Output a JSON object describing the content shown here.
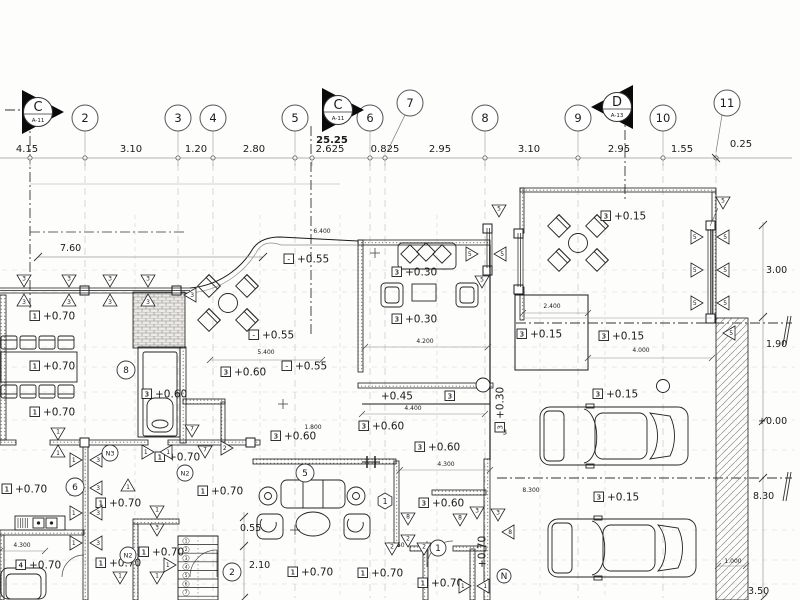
{
  "drawing": {
    "type": "architectural-floor-plan",
    "overall_dim": "25.25",
    "section_markers": [
      {
        "label": "C",
        "ref": "A-11",
        "x": 38,
        "y": 112,
        "dir": "r"
      },
      {
        "label": "C",
        "ref": "A-11",
        "x": 338,
        "y": 110,
        "dir": "r"
      },
      {
        "label": "D",
        "ref": "A-13",
        "x": 617,
        "y": 107,
        "dir": "l"
      }
    ],
    "grid_bubbles": [
      {
        "label": "2",
        "x": 85,
        "y": 118
      },
      {
        "label": "3",
        "x": 178,
        "y": 118
      },
      {
        "label": "4",
        "x": 213,
        "y": 118
      },
      {
        "label": "5",
        "x": 295,
        "y": 118
      },
      {
        "label": "6",
        "x": 370,
        "y": 118
      },
      {
        "label": "7",
        "x": 410,
        "y": 103,
        "lx": 387,
        "ly": 152
      },
      {
        "label": "8",
        "x": 485,
        "y": 118
      },
      {
        "label": "9",
        "x": 578,
        "y": 118
      },
      {
        "label": "10",
        "x": 663,
        "y": 118
      },
      {
        "label": "11",
        "x": 727,
        "y": 103,
        "lx": 716,
        "ly": 152
      }
    ],
    "top_dims": [
      {
        "t": "4.15",
        "x": 27,
        "y": 152
      },
      {
        "t": "3.10",
        "x": 131,
        "y": 152
      },
      {
        "t": "1.20",
        "x": 196,
        "y": 152
      },
      {
        "t": "2.80",
        "x": 254,
        "y": 152
      },
      {
        "t": "2.625",
        "x": 330,
        "y": 152
      },
      {
        "t": "0.825",
        "x": 385,
        "y": 152
      },
      {
        "t": "2.95",
        "x": 440,
        "y": 152
      },
      {
        "t": "3.10",
        "x": 529,
        "y": 152
      },
      {
        "t": "2.95",
        "x": 619,
        "y": 152
      },
      {
        "t": "1.55",
        "x": 682,
        "y": 152
      },
      {
        "t": "0.25",
        "x": 741,
        "y": 147
      }
    ],
    "dim_ticks_x": [
      30,
      85,
      178,
      213,
      295,
      312,
      370,
      385,
      485,
      578,
      663,
      716
    ],
    "overall_dim_pos": {
      "x": 332,
      "y": 143
    },
    "side_dims": [
      {
        "t": "7.60",
        "x": 60,
        "y": 251
      },
      {
        "t": "3.00",
        "x": 766,
        "y": 273
      },
      {
        "t": "1.90",
        "x": 766,
        "y": 347
      },
      {
        "t": "+0.00",
        "x": 758,
        "y": 424
      },
      {
        "t": "8.30",
        "x": 753,
        "y": 499
      },
      {
        "t": "3.50",
        "x": 748,
        "y": 594
      },
      {
        "t": "0.55",
        "x": 240,
        "y": 531
      },
      {
        "t": "2.10",
        "x": 249,
        "y": 568
      }
    ],
    "interior_dims": [
      {
        "t": "6.400",
        "x": 322,
        "y": 233
      },
      {
        "t": "5.400",
        "x": 266,
        "y": 354
      },
      {
        "t": "4.200",
        "x": 425,
        "y": 343
      },
      {
        "t": "4.400",
        "x": 413,
        "y": 410
      },
      {
        "t": "4.300",
        "x": 446,
        "y": 466
      },
      {
        "t": "1.800",
        "x": 313,
        "y": 429
      },
      {
        "t": "2.400",
        "x": 552,
        "y": 308
      },
      {
        "t": "4.000",
        "x": 641,
        "y": 352
      },
      {
        "t": "5.450",
        "x": 396,
        "y": 547
      },
      {
        "t": "4.300",
        "x": 22,
        "y": 547
      },
      {
        "t": "8.300",
        "x": 531,
        "y": 492
      },
      {
        "t": "1.000",
        "x": 733,
        "y": 563
      }
    ],
    "elevation_labels": [
      {
        "b": "1",
        "v": "+0.70",
        "x": 30,
        "y": 316
      },
      {
        "b": "1",
        "v": "+0.70",
        "x": 30,
        "y": 366
      },
      {
        "b": "1",
        "v": "+0.70",
        "x": 30,
        "y": 412
      },
      {
        "b": "1",
        "v": "+0.70",
        "x": 2,
        "y": 489
      },
      {
        "b": "4",
        "v": "+0.70",
        "x": 16,
        "y": 565
      },
      {
        "b": "1",
        "v": "+0.70",
        "x": 96,
        "y": 503
      },
      {
        "b": "1",
        "v": "+0.70",
        "x": 96,
        "y": 563
      },
      {
        "b": "1",
        "v": "+0.70",
        "x": 198,
        "y": 491
      },
      {
        "b": "1",
        "v": "+0.70",
        "x": 139,
        "y": 552
      },
      {
        "b": "1",
        "v": "+0.70",
        "x": 155,
        "y": 457
      },
      {
        "b": "1",
        "v": "+0.70",
        "x": 288,
        "y": 572
      },
      {
        "b": "1",
        "v": "+0.70",
        "x": 358,
        "y": 573
      },
      {
        "b": "1",
        "v": "+0.70",
        "x": 418,
        "y": 583
      },
      {
        "b": "-",
        "v": "+0.55",
        "x": 284,
        "y": 259
      },
      {
        "b": "-",
        "v": "+0.55",
        "x": 249,
        "y": 335
      },
      {
        "b": "-",
        "v": "+0.55",
        "x": 282,
        "y": 366
      },
      {
        "b": "3",
        "v": "+0.60",
        "x": 142,
        "y": 394
      },
      {
        "b": "3",
        "v": "+0.60",
        "x": 221,
        "y": 372
      },
      {
        "b": "3",
        "v": "+0.60",
        "x": 271,
        "y": 436
      },
      {
        "b": "3",
        "v": "+0.60",
        "x": 359,
        "y": 426
      },
      {
        "b": "3",
        "v": "+0.60",
        "x": 415,
        "y": 447
      },
      {
        "b": "3",
        "v": "+0.60",
        "x": 419,
        "y": 503
      },
      {
        "b": "3",
        "v": "+0.30",
        "x": 392,
        "y": 272
      },
      {
        "b": "3",
        "v": "+0.30",
        "x": 392,
        "y": 319
      },
      {
        "b": "3",
        "v": "+0.45",
        "x": 413,
        "y": 396,
        "rev": 1
      },
      {
        "b": "3",
        "v": "+0.30",
        "x": 500,
        "y": 432,
        "rot": -90
      },
      {
        "b": "3",
        "v": "+0.15",
        "x": 601,
        "y": 216
      },
      {
        "b": "3",
        "v": "+0.15",
        "x": 517,
        "y": 334
      },
      {
        "b": "3",
        "v": "+0.15",
        "x": 599,
        "y": 336
      },
      {
        "b": "3",
        "v": "+0.15",
        "x": 593,
        "y": 394
      },
      {
        "b": "3",
        "v": "+0.15",
        "x": 594,
        "y": 497
      },
      {
        "b": "",
        "v": "+0.70",
        "x": 482,
        "y": 568,
        "rot": -90
      }
    ],
    "triangle_markers": [
      {
        "n": "3",
        "x": 24,
        "y": 281,
        "d": "d"
      },
      {
        "n": "3",
        "x": 24,
        "y": 300,
        "d": "u"
      },
      {
        "n": "3",
        "x": 69,
        "y": 281,
        "d": "d"
      },
      {
        "n": "3",
        "x": 69,
        "y": 300,
        "d": "u"
      },
      {
        "n": "3",
        "x": 110,
        "y": 281,
        "d": "d"
      },
      {
        "n": "3",
        "x": 110,
        "y": 300,
        "d": "u"
      },
      {
        "n": "3",
        "x": 148,
        "y": 281,
        "d": "d"
      },
      {
        "n": "3",
        "x": 148,
        "y": 300,
        "d": "u"
      },
      {
        "n": "3",
        "x": 190,
        "y": 295,
        "d": "l"
      },
      {
        "n": "5",
        "x": 472,
        "y": 254,
        "d": "r"
      },
      {
        "n": "5",
        "x": 500,
        "y": 254,
        "d": "l"
      },
      {
        "n": "5",
        "x": 482,
        "y": 282,
        "d": "d"
      },
      {
        "n": "5",
        "x": 499,
        "y": 211,
        "d": "d"
      },
      {
        "n": "5",
        "x": 697,
        "y": 237,
        "d": "r"
      },
      {
        "n": "5",
        "x": 723,
        "y": 237,
        "d": "l"
      },
      {
        "n": "5",
        "x": 697,
        "y": 270,
        "d": "r"
      },
      {
        "n": "5",
        "x": 723,
        "y": 270,
        "d": "l"
      },
      {
        "n": "5",
        "x": 697,
        "y": 303,
        "d": "r"
      },
      {
        "n": "5",
        "x": 723,
        "y": 303,
        "d": "l"
      },
      {
        "n": "5",
        "x": 723,
        "y": 203,
        "d": "d"
      },
      {
        "n": "5",
        "x": 729,
        "y": 333,
        "d": "l"
      },
      {
        "n": "1",
        "x": 76,
        "y": 460,
        "d": "r"
      },
      {
        "n": "3",
        "x": 96,
        "y": 460,
        "d": "l"
      },
      {
        "n": "1",
        "x": 76,
        "y": 488,
        "d": "r"
      },
      {
        "n": "3",
        "x": 96,
        "y": 488,
        "d": "l"
      },
      {
        "n": "1",
        "x": 76,
        "y": 513,
        "d": "r"
      },
      {
        "n": "3",
        "x": 96,
        "y": 513,
        "d": "l"
      },
      {
        "n": "1",
        "x": 76,
        "y": 543,
        "d": "r"
      },
      {
        "n": "3",
        "x": 96,
        "y": 543,
        "d": "l"
      },
      {
        "n": "1",
        "x": 58,
        "y": 434,
        "d": "d"
      },
      {
        "n": "1",
        "x": 58,
        "y": 451,
        "d": "u"
      },
      {
        "n": "7",
        "x": 192,
        "y": 431,
        "d": "d"
      },
      {
        "n": "7",
        "x": 205,
        "y": 452,
        "d": "d"
      },
      {
        "n": "2",
        "x": 227,
        "y": 448,
        "d": "r"
      },
      {
        "n": "1",
        "x": 148,
        "y": 452,
        "d": "r"
      },
      {
        "n": "1",
        "x": 166,
        "y": 452,
        "d": "l"
      },
      {
        "n": "1",
        "x": 128,
        "y": 485,
        "d": "u"
      },
      {
        "n": "1",
        "x": 157,
        "y": 512,
        "d": "d"
      },
      {
        "n": "3",
        "x": 157,
        "y": 530,
        "d": "d"
      },
      {
        "n": "1",
        "x": 170,
        "y": 565,
        "d": "r"
      },
      {
        "n": "1",
        "x": 157,
        "y": 578,
        "d": "d"
      },
      {
        "n": "1",
        "x": 120,
        "y": 578,
        "d": "d"
      },
      {
        "n": "8",
        "x": 408,
        "y": 519,
        "d": "d"
      },
      {
        "n": "2",
        "x": 408,
        "y": 541,
        "d": "d"
      },
      {
        "n": "8",
        "x": 460,
        "y": 520,
        "d": "d"
      },
      {
        "n": "3",
        "x": 477,
        "y": 513,
        "d": "d"
      },
      {
        "n": "3",
        "x": 498,
        "y": 515,
        "d": "d"
      },
      {
        "n": "8",
        "x": 508,
        "y": 532,
        "d": "l"
      },
      {
        "n": "2",
        "x": 392,
        "y": 549,
        "d": "d"
      },
      {
        "n": "2",
        "x": 424,
        "y": 549,
        "d": "d"
      },
      {
        "n": "1",
        "x": 465,
        "y": 586,
        "d": "r"
      },
      {
        "n": "1",
        "x": 483,
        "y": 586,
        "d": "l"
      }
    ],
    "circle_tags": [
      {
        "n": "8",
        "x": 126,
        "y": 370,
        "r": 9
      },
      {
        "n": "6",
        "x": 75,
        "y": 487,
        "r": 9
      },
      {
        "n": "5",
        "x": 305,
        "y": 473,
        "r": 9
      },
      {
        "n": "2",
        "x": 232,
        "y": 572,
        "r": 9
      },
      {
        "n": "1",
        "x": 438,
        "y": 548,
        "r": 8
      },
      {
        "n": "N2",
        "x": 185,
        "y": 473,
        "r": 8
      },
      {
        "n": "N3",
        "x": 110,
        "y": 453,
        "r": 8
      },
      {
        "n": "N2",
        "x": 128,
        "y": 555,
        "r": 8
      },
      {
        "n": "N",
        "x": 504,
        "y": 576,
        "r": 7
      }
    ],
    "hex_tags": [
      {
        "n": "1",
        "x": 385,
        "y": 501,
        "r": 8
      }
    ],
    "stairs": {
      "numbers": [
        "1",
        "2",
        "3",
        "4",
        "5",
        "6",
        "7"
      ],
      "x": 186,
      "y0": 541,
      "step": 8.6
    }
  }
}
